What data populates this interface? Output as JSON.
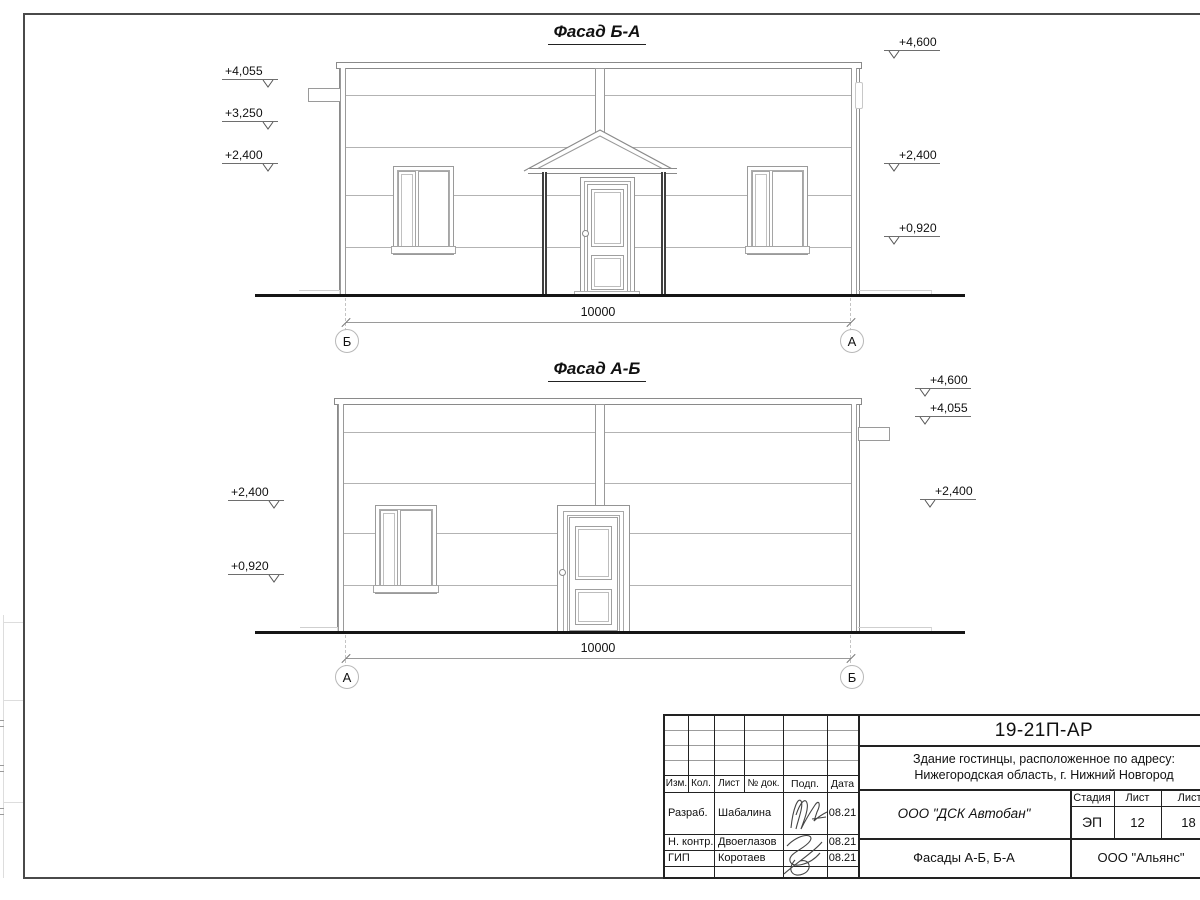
{
  "colors": {
    "frame": "#4a4a4a",
    "table_line": "#222222",
    "drawing_line": "#8a8a8a",
    "thin_line": "#b3b3b3",
    "ground": "#151515",
    "text": "#111111"
  },
  "facade1": {
    "title": "Фасад Б-А",
    "elev_left": [
      "+4,055",
      "+3,250",
      "+2,400"
    ],
    "elev_right": [
      "+4,600",
      "+2,400",
      "+0,920"
    ],
    "dimension": "10000",
    "axis_left": "Б",
    "axis_right": "А"
  },
  "facade2": {
    "title": "Фасад А-Б",
    "elev_left": [
      "+2,400",
      "+0,920"
    ],
    "elev_right": [
      "+4,600",
      "+4,055",
      "+2,400"
    ],
    "dimension": "10000",
    "axis_left": "А",
    "axis_right": "Б"
  },
  "titleblock": {
    "doc_number": "19-21П-АР",
    "address_line1": "Здание гостинцы, расположенное по адресу:",
    "address_line2": "Нижегородская область, г. Нижний Новгород",
    "col_headers": {
      "izm": "Изм.",
      "kol": "Кол.",
      "list": "Лист",
      "doc": "№ док.",
      "podp": "Подп.",
      "data": "Дата"
    },
    "rows": [
      {
        "role": "Разраб.",
        "name": "Шабалина",
        "date": "08.21"
      },
      {
        "role": "Н. контр.",
        "name": "Двоеглазов",
        "date": "08.21"
      },
      {
        "role": "ГИП",
        "name": "Коротаев",
        "date": "08.21"
      }
    ],
    "company": "ООО \"ДСК Автобан\"",
    "sheet_title": "Фасады А-Б, Б-А",
    "contractor": "ООО \"Альянс\"",
    "stage_label": "Стадия",
    "stage_value": "ЭП",
    "sheet_label": "Лист",
    "sheet_value": "12",
    "sheets_label": "Листов",
    "sheets_value": "18"
  }
}
